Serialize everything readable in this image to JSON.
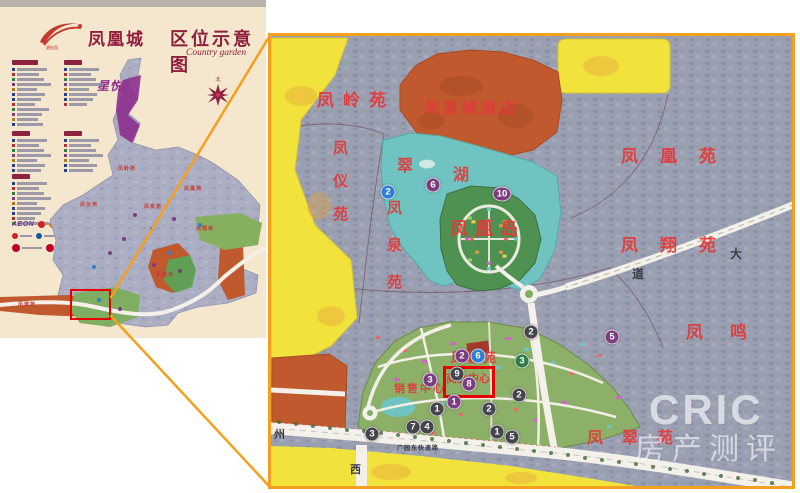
{
  "palette": {
    "cream": "#f4e7cd",
    "orange_border": "#f59f1f",
    "red_highlight": "#e60000",
    "label_red": "#e23a3a",
    "title_red": "#8e1f3c",
    "purple_patch": "#8e2d8e",
    "marker_blue": "#2e7ed2",
    "marker_purple": "#7c3c80",
    "marker_dark": "#45454c",
    "marker_green": "#2f7d46",
    "zone_orange": "#c05a2e",
    "zone_yellow": "#f2e23c",
    "lake_teal": "#6fc3c0",
    "map_gray": "#9aa0b2"
  },
  "left_panel": {
    "brand_name": "凤凰城",
    "brand_sub": "碧桂园",
    "title": "区位示意图",
    "subtitle": "Country garden",
    "compass_label": "北",
    "star_label": "星悦",
    "legend_sections": [
      {
        "x": 12,
        "y": 60,
        "header_w": 26,
        "rows": 12
      },
      {
        "x": 64,
        "y": 60,
        "header_w": 18,
        "rows": 8
      },
      {
        "x": 12,
        "y": 131,
        "header_w": 18,
        "rows": 7
      },
      {
        "x": 64,
        "y": 131,
        "header_w": 18,
        "rows": 7
      },
      {
        "x": 12,
        "y": 174,
        "header_w": 18,
        "rows": 9
      }
    ],
    "legend_bar_widths": [
      30,
      22,
      27,
      34,
      20,
      28,
      24,
      18,
      32,
      25,
      21,
      26
    ],
    "legend_bullet_colors": [
      "#24408e",
      "#b03030",
      "#2f7d46",
      "#7c3c80",
      "#b07820",
      "#24408e"
    ],
    "partners": {
      "aeon_label": "AEON",
      "row1_icons": [
        "#cc2222",
        "#e07818",
        "#1558a8",
        "#cc2222",
        "#2f7d46",
        "#777788"
      ],
      "row2_icons": [
        "#cc2222",
        "#1558a8",
        "#e07818",
        "#2f7d46",
        "#cc2222",
        "#999999"
      ],
      "row3_icons": [
        "#c00023",
        "#c00023",
        "#1558a8",
        "#c00023"
      ]
    },
    "map_labels": [
      {
        "t": "凤岭苑",
        "x": 118,
        "y": 110
      },
      {
        "t": "凤仪苑",
        "x": 80,
        "y": 146
      },
      {
        "t": "凤泉苑",
        "x": 144,
        "y": 148
      },
      {
        "t": "凤凰苑",
        "x": 184,
        "y": 130
      },
      {
        "t": "凤翔苑",
        "x": 196,
        "y": 170
      },
      {
        "t": "凤凰岛",
        "x": 156,
        "y": 216
      },
      {
        "t": "凤翠苑",
        "x": 18,
        "y": 246
      }
    ],
    "map_dots": [
      {
        "x": 92,
        "y": 210,
        "c": "#2e7ed2"
      },
      {
        "x": 108,
        "y": 196,
        "c": "#7c3c80"
      },
      {
        "x": 122,
        "y": 182,
        "c": "#7c3c80"
      },
      {
        "x": 150,
        "y": 172,
        "c": "#2e7ed2"
      },
      {
        "x": 172,
        "y": 162,
        "c": "#7c3c80"
      },
      {
        "x": 198,
        "y": 168,
        "c": "#2e7ed2"
      },
      {
        "x": 152,
        "y": 208,
        "c": "#7c3c80"
      },
      {
        "x": 168,
        "y": 196,
        "c": "#2e7ed2"
      },
      {
        "x": 133,
        "y": 158,
        "c": "#7c3c80"
      },
      {
        "x": 178,
        "y": 214,
        "c": "#7c3c80"
      },
      {
        "x": 97,
        "y": 243,
        "c": "#2e7ed2"
      },
      {
        "x": 118,
        "y": 252,
        "c": "#7c3c80"
      }
    ]
  },
  "right_map": {
    "labels": [
      {
        "t": "凤岭苑",
        "x": 46,
        "y": 50,
        "s": 17,
        "ls": 9
      },
      {
        "t": "凤凰城酒店",
        "x": 153,
        "y": 61,
        "s": 15,
        "ls": 4
      },
      {
        "t": "翠",
        "x": 126,
        "y": 116,
        "s": 16
      },
      {
        "t": "湖",
        "x": 182,
        "y": 125,
        "s": 16
      },
      {
        "t": "凤仪苑",
        "x": 58,
        "y": 104,
        "s": 15,
        "v": 1,
        "ls": 18
      },
      {
        "t": "凤泉苑",
        "x": 112,
        "y": 164,
        "s": 15,
        "v": 1,
        "ls": 22
      },
      {
        "t": "凤凰苑",
        "x": 350,
        "y": 106,
        "s": 17,
        "ls": 22
      },
      {
        "t": "凤翔苑",
        "x": 350,
        "y": 195,
        "s": 17,
        "ls": 22
      },
      {
        "t": "凤鸣",
        "x": 415,
        "y": 282,
        "s": 17,
        "ls": 27
      },
      {
        "t": "凤翠苑",
        "x": 316,
        "y": 388,
        "s": 16,
        "ls": 19
      },
      {
        "t": "凤凰岛",
        "x": 179,
        "y": 179,
        "s": 18,
        "ls": 7
      },
      {
        "t": "凤馨苑",
        "x": 180,
        "y": 311,
        "s": 13,
        "ls": 3
      },
      {
        "t": "销售中心",
        "x": 123,
        "y": 344,
        "s": 11,
        "ls": 2
      },
      {
        "t": "商业中心",
        "x": 175,
        "y": 334,
        "s": 11,
        "ls": 0
      },
      {
        "t": "大",
        "x": 459,
        "y": 209,
        "s": 12,
        "c": "dark"
      },
      {
        "t": "道",
        "x": 361,
        "y": 229,
        "s": 12,
        "c": "dark"
      },
      {
        "t": "州",
        "x": 3,
        "y": 390,
        "s": 11,
        "c": "dark"
      },
      {
        "t": "西",
        "x": 79,
        "y": 425,
        "s": 11,
        "c": "dark"
      },
      {
        "t": "广园东快速路",
        "x": 126,
        "y": 407,
        "s": 6,
        "ls": 1,
        "c": "dark"
      }
    ],
    "markers": [
      {
        "n": "2",
        "c": "blue",
        "x": 117,
        "y": 156
      },
      {
        "n": "6",
        "c": "purple",
        "x": 162,
        "y": 149
      },
      {
        "n": "10",
        "c": "purple",
        "x": 231,
        "y": 158,
        "w": 19
      },
      {
        "n": "5",
        "c": "purple",
        "x": 341,
        "y": 301
      },
      {
        "n": "2",
        "c": "purple",
        "x": 191,
        "y": 320
      },
      {
        "n": "6",
        "c": "blue",
        "x": 207,
        "y": 320
      },
      {
        "n": "3",
        "c": "purple",
        "x": 159,
        "y": 344
      },
      {
        "n": "9",
        "c": "dark",
        "x": 186,
        "y": 338
      },
      {
        "n": "8",
        "c": "purple",
        "x": 198,
        "y": 348
      },
      {
        "n": "1",
        "c": "purple",
        "x": 183,
        "y": 366
      },
      {
        "n": "1",
        "c": "dark",
        "x": 166,
        "y": 373
      },
      {
        "n": "2",
        "c": "dark",
        "x": 218,
        "y": 373
      },
      {
        "n": "2",
        "c": "dark",
        "x": 260,
        "y": 296
      },
      {
        "n": "3",
        "c": "green",
        "x": 251,
        "y": 325
      },
      {
        "n": "2",
        "c": "dark",
        "x": 248,
        "y": 359
      },
      {
        "n": "3",
        "c": "dark",
        "x": 101,
        "y": 398
      },
      {
        "n": "7",
        "c": "dark",
        "x": 142,
        "y": 391
      },
      {
        "n": "4",
        "c": "dark",
        "x": 156,
        "y": 391
      },
      {
        "n": "1",
        "c": "dark",
        "x": 226,
        "y": 396
      },
      {
        "n": "5",
        "c": "dark",
        "x": 241,
        "y": 401
      }
    ],
    "watermark": {
      "line1": "CRIC",
      "line2": "房产测评"
    }
  }
}
